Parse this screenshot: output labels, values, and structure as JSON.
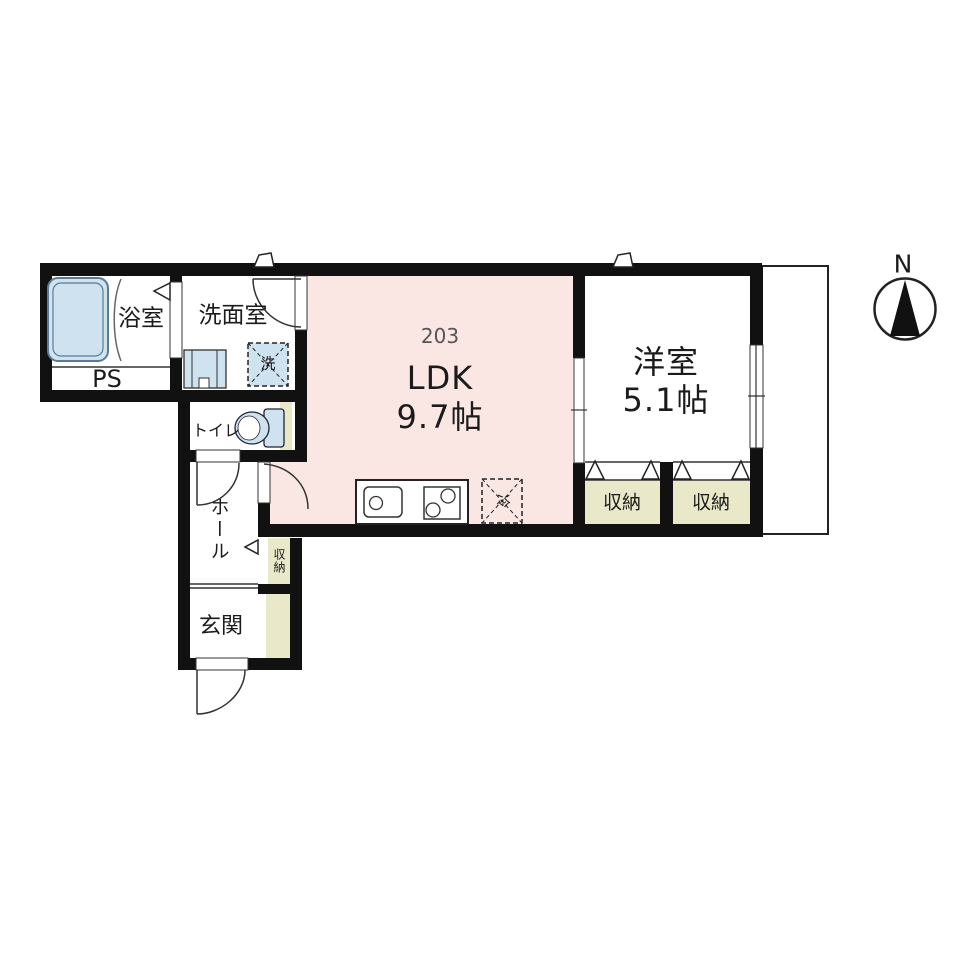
{
  "unit": {
    "number": "203"
  },
  "compass": {
    "north_label": "N"
  },
  "rooms": {
    "bathroom": {
      "label": "浴室"
    },
    "washroom": {
      "label": "洗面室"
    },
    "pipe_space": {
      "label": "PS"
    },
    "toilet": {
      "label": "トイレ"
    },
    "hall": {
      "label": "ホール"
    },
    "hall_closet": {
      "label": "収納"
    },
    "entrance": {
      "label": "玄関"
    },
    "ldk": {
      "label": "LDK",
      "size": "9.7帖"
    },
    "western_room": {
      "label": "洋室",
      "size": "5.1帖"
    },
    "closet_left": {
      "label": "収納"
    },
    "closet_right": {
      "label": "収納"
    }
  },
  "appliances": {
    "washer": {
      "label": "洗"
    },
    "refrigerator": {
      "label": "冷"
    }
  },
  "colors": {
    "wall": "#111111",
    "ldk_pink": "#fae6e2",
    "tatami_beige": "#e9e9ca",
    "fixture_blue": "#cfe2f0",
    "fixture_blue_border": "#5b7a94",
    "line": "#333333",
    "unit_number_gray": "#555555"
  }
}
